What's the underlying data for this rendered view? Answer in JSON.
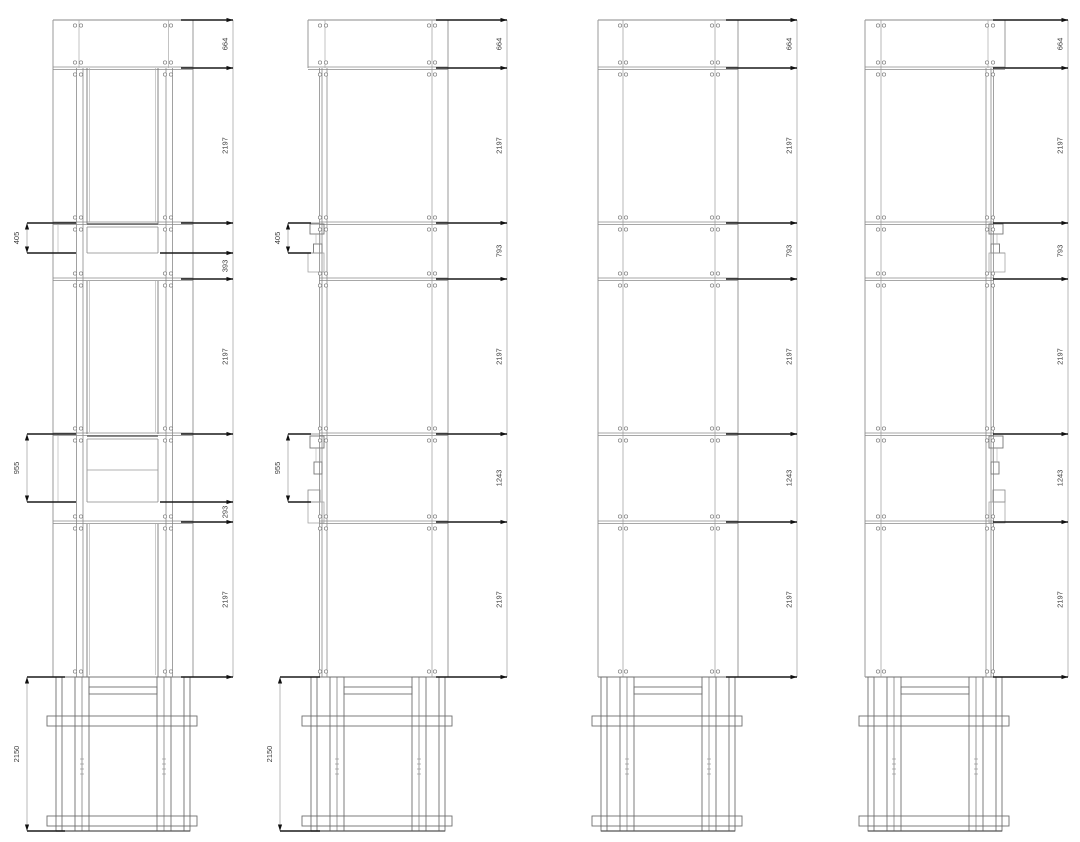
{
  "drawing": {
    "views": [
      {
        "id": "elevation-1",
        "right_dims": [
          "664",
          "2197",
          "393",
          "2197",
          "293",
          "2197"
        ],
        "left_dims": [
          "405",
          "955"
        ],
        "bottom_dim": "2150"
      },
      {
        "id": "elevation-2",
        "right_dims": [
          "664",
          "2197",
          "793",
          "2197",
          "1243",
          "2197"
        ],
        "left_dims": [
          "405",
          "955"
        ],
        "bottom_dim": "2150"
      },
      {
        "id": "elevation-3",
        "right_dims": [
          "664",
          "2197",
          "793",
          "2197",
          "1243",
          "2197"
        ],
        "left_dims": [],
        "bottom_dim": ""
      },
      {
        "id": "elevation-4",
        "right_dims": [
          "664",
          "2197",
          "793",
          "2197",
          "1243",
          "2197"
        ],
        "left_dims": [],
        "bottom_dim": ""
      }
    ],
    "colors": {
      "background": "#ffffff",
      "panel_line": "#999999",
      "joint_line": "#8a8a8a",
      "detail_line": "#aaaaaa",
      "frame_line": "#6e6e6e",
      "sill_line": "#666666",
      "dim_bold": "#1a1a1a",
      "dim_thin": "#9a9a9a",
      "text": "#3c3c3c"
    }
  }
}
